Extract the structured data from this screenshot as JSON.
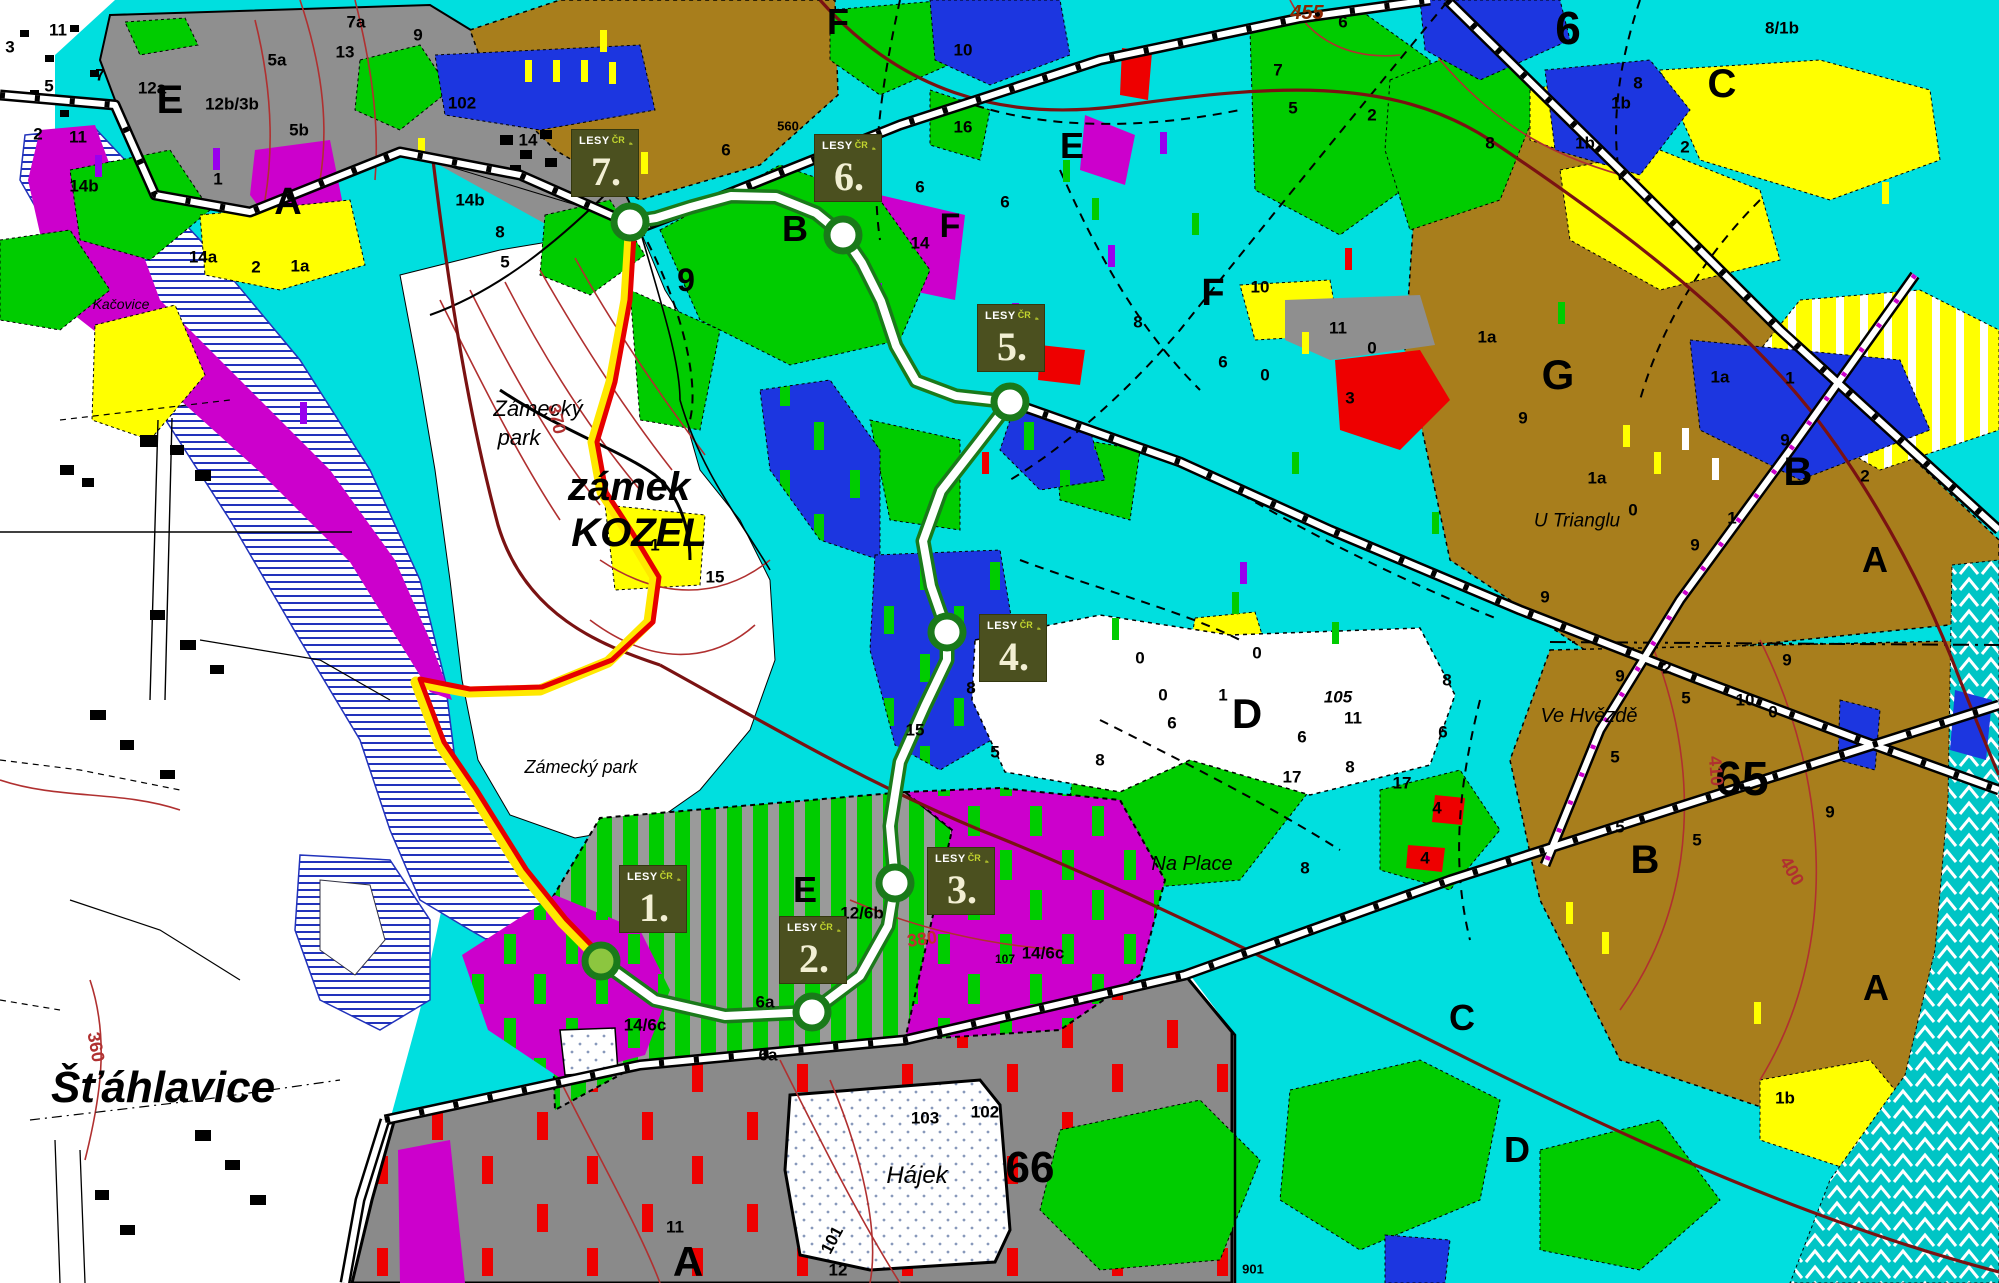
{
  "map": {
    "region_name": "zamek Kozel forest map",
    "marker_logo": {
      "lesy": "LESY",
      "cr": "ČR"
    },
    "waypoints": [
      {
        "id": "1",
        "num": "1.",
        "bx": 620,
        "by": 866,
        "cx": 601,
        "cy": 961,
        "start": true
      },
      {
        "id": "2",
        "num": "2.",
        "bx": 780,
        "by": 917,
        "cx": 812,
        "cy": 1012
      },
      {
        "id": "3",
        "num": "3.",
        "bx": 928,
        "by": 848,
        "cx": 895,
        "cy": 883
      },
      {
        "id": "4",
        "num": "4.",
        "bx": 980,
        "by": 615,
        "cx": 947,
        "cy": 632
      },
      {
        "id": "5",
        "num": "5.",
        "bx": 978,
        "by": 305,
        "cx": 1010,
        "cy": 402
      },
      {
        "id": "6",
        "num": "6.",
        "bx": 815,
        "by": 135,
        "cx": 843,
        "cy": 235
      },
      {
        "id": "7",
        "num": "7.",
        "bx": 572,
        "by": 130,
        "cx": 630,
        "cy": 222
      }
    ]
  },
  "labels": [
    {
      "t": "Šťáhlavice",
      "x": 163,
      "y": 1088,
      "s": 44,
      "i": 1,
      "fw": "b",
      "n": "village-label"
    },
    {
      "t": "zámek",
      "x": 629,
      "y": 487,
      "s": 40,
      "i": 1,
      "fw": "b",
      "n": "castle-label"
    },
    {
      "t": "KOZEL",
      "x": 639,
      "y": 533,
      "s": 40,
      "i": 1,
      "fw": "b",
      "n": "castle-label"
    },
    {
      "t": "Zámecký",
      "x": 538,
      "y": 409,
      "s": 22,
      "i": 1,
      "fw": "n",
      "n": "park-label"
    },
    {
      "t": "park",
      "x": 519,
      "y": 438,
      "s": 22,
      "i": 1,
      "fw": "n",
      "n": "park-label"
    },
    {
      "t": "Zámecký park",
      "x": 581,
      "y": 767,
      "s": 18,
      "i": 1,
      "fw": "n",
      "n": "park-label"
    },
    {
      "t": "Hájek",
      "x": 917,
      "y": 1176,
      "s": 24,
      "i": 1,
      "fw": "n",
      "n": "place-label"
    },
    {
      "t": "Na Place",
      "x": 1192,
      "y": 864,
      "s": 20,
      "i": 1,
      "fw": "n",
      "n": "place-label"
    },
    {
      "t": "Ve Hvězdě",
      "x": 1589,
      "y": 716,
      "s": 20,
      "i": 1,
      "fw": "n",
      "n": "place-label"
    },
    {
      "t": "U Trianglu",
      "x": 1577,
      "y": 521,
      "s": 19,
      "i": 1,
      "fw": "n",
      "n": "place-label"
    },
    {
      "t": "Kačovice",
      "x": 121,
      "y": 304,
      "s": 14,
      "i": 1,
      "fw": "n",
      "n": "place-label"
    },
    {
      "t": "E",
      "x": 170,
      "y": 100,
      "s": 40,
      "n": "section-letter"
    },
    {
      "t": "A",
      "x": 288,
      "y": 202,
      "s": 38,
      "n": "section-letter"
    },
    {
      "t": "F",
      "x": 838,
      "y": 22,
      "s": 36,
      "n": "section-letter"
    },
    {
      "t": "F",
      "x": 950,
      "y": 226,
      "s": 34,
      "n": "section-letter"
    },
    {
      "t": "E",
      "x": 1072,
      "y": 146,
      "s": 36,
      "n": "section-letter"
    },
    {
      "t": "B",
      "x": 795,
      "y": 229,
      "s": 36,
      "n": "section-letter"
    },
    {
      "t": "9",
      "x": 686,
      "y": 280,
      "s": 32,
      "n": "section-number"
    },
    {
      "t": "F",
      "x": 1213,
      "y": 293,
      "s": 38,
      "n": "section-letter"
    },
    {
      "t": "6",
      "x": 1568,
      "y": 28,
      "s": 46,
      "n": "section-number"
    },
    {
      "t": "C",
      "x": 1722,
      "y": 84,
      "s": 40,
      "n": "section-letter"
    },
    {
      "t": "G",
      "x": 1558,
      "y": 375,
      "s": 42,
      "n": "section-letter"
    },
    {
      "t": "B",
      "x": 1798,
      "y": 472,
      "s": 40,
      "n": "section-letter"
    },
    {
      "t": "A",
      "x": 1875,
      "y": 560,
      "s": 36,
      "n": "section-letter"
    },
    {
      "t": "B",
      "x": 1645,
      "y": 860,
      "s": 40,
      "n": "section-letter"
    },
    {
      "t": "65",
      "x": 1742,
      "y": 780,
      "s": 48,
      "fw": "b",
      "n": "section-number"
    },
    {
      "t": "A",
      "x": 1876,
      "y": 988,
      "s": 36,
      "n": "section-letter"
    },
    {
      "t": "D",
      "x": 1247,
      "y": 714,
      "s": 42,
      "n": "section-letter"
    },
    {
      "t": "C",
      "x": 1462,
      "y": 1018,
      "s": 36,
      "n": "section-letter"
    },
    {
      "t": "D",
      "x": 1517,
      "y": 1150,
      "s": 36,
      "n": "section-letter"
    },
    {
      "t": "E",
      "x": 805,
      "y": 890,
      "s": 36,
      "n": "section-letter"
    },
    {
      "t": "A",
      "x": 688,
      "y": 1262,
      "s": 42,
      "n": "section-letter"
    },
    {
      "t": "66",
      "x": 1030,
      "y": 1168,
      "s": 44,
      "fw": "b",
      "n": "section-number"
    },
    {
      "t": "370",
      "x": 557,
      "y": 419,
      "s": 18,
      "r": 78,
      "c": "#B03030",
      "n": "contour-label"
    },
    {
      "t": "360",
      "x": 96,
      "y": 1047,
      "s": 18,
      "r": 80,
      "c": "#B03030",
      "n": "contour-label"
    },
    {
      "t": "380",
      "x": 922,
      "y": 939,
      "s": 18,
      "r": -8,
      "c": "#C03030",
      "n": "contour-label"
    },
    {
      "t": "410",
      "x": 1716,
      "y": 771,
      "s": 18,
      "r": 85,
      "c": "#B03030",
      "n": "contour-label"
    },
    {
      "t": "400",
      "x": 1792,
      "y": 871,
      "s": 18,
      "r": 60,
      "c": "#B03030",
      "n": "contour-label"
    },
    {
      "t": "455",
      "x": 1307,
      "y": 13,
      "s": 20,
      "i": 1,
      "c": "#8B2500",
      "n": "contour-label"
    },
    {
      "t": "560",
      "x": 788,
      "y": 126,
      "s": 13,
      "n": "height-label"
    },
    {
      "t": "901",
      "x": 1253,
      "y": 1269,
      "s": 13,
      "n": "parcel-label"
    },
    {
      "t": "107",
      "x": 1005,
      "y": 959,
      "s": 12,
      "n": "parcel-label"
    },
    {
      "t": "7a",
      "x": 356,
      "y": 22
    },
    {
      "t": "12a",
      "x": 152,
      "y": 88
    },
    {
      "t": "12b/3b",
      "x": 232,
      "y": 104
    },
    {
      "t": "5a",
      "x": 277,
      "y": 60
    },
    {
      "t": "5b",
      "x": 299,
      "y": 130
    },
    {
      "t": "11",
      "x": 78,
      "y": 137
    },
    {
      "t": "14b",
      "x": 84,
      "y": 186
    },
    {
      "t": "14a",
      "x": 203,
      "y": 257
    },
    {
      "t": "1a",
      "x": 300,
      "y": 266
    },
    {
      "t": "2",
      "x": 256,
      "y": 267
    },
    {
      "t": "1",
      "x": 218,
      "y": 179
    },
    {
      "t": "7",
      "x": 100,
      "y": 75
    },
    {
      "t": "2",
      "x": 38,
      "y": 134
    },
    {
      "t": "3",
      "x": 10,
      "y": 47
    },
    {
      "t": "11",
      "x": 58,
      "y": 30
    },
    {
      "t": "5",
      "x": 49,
      "y": 86
    },
    {
      "t": "14b",
      "x": 470,
      "y": 200
    },
    {
      "t": "5",
      "x": 505,
      "y": 262
    },
    {
      "t": "102",
      "x": 462,
      "y": 103
    },
    {
      "t": "9",
      "x": 418,
      "y": 35
    },
    {
      "t": "13",
      "x": 345,
      "y": 52
    },
    {
      "t": "14",
      "x": 528,
      "y": 140
    },
    {
      "t": "8",
      "x": 500,
      "y": 232
    },
    {
      "t": "6",
      "x": 726,
      "y": 150
    },
    {
      "t": "1",
      "x": 655,
      "y": 545
    },
    {
      "t": "15",
      "x": 715,
      "y": 577
    },
    {
      "t": "12/6b",
      "x": 862,
      "y": 913
    },
    {
      "t": "14/6c",
      "x": 645,
      "y": 1025
    },
    {
      "t": "14/6c",
      "x": 1043,
      "y": 953
    },
    {
      "t": "6a",
      "x": 765,
      "y": 1002
    },
    {
      "t": "6a",
      "x": 768,
      "y": 1055
    },
    {
      "t": "103",
      "x": 925,
      "y": 1118
    },
    {
      "t": "102",
      "x": 985,
      "y": 1112
    },
    {
      "t": "101",
      "x": 832,
      "y": 1240,
      "r": -62
    },
    {
      "t": "11",
      "x": 675,
      "y": 1227
    },
    {
      "t": "12",
      "x": 838,
      "y": 1270
    },
    {
      "t": "105",
      "x": 1338,
      "y": 697,
      "i": 1
    },
    {
      "t": "11",
      "x": 1353,
      "y": 718
    },
    {
      "t": "17",
      "x": 1292,
      "y": 777
    },
    {
      "t": "17",
      "x": 1402,
      "y": 783
    },
    {
      "t": "11",
      "x": 1338,
      "y": 328
    },
    {
      "t": "3",
      "x": 1350,
      "y": 398
    },
    {
      "t": "0",
      "x": 1265,
      "y": 375
    },
    {
      "t": "0",
      "x": 1372,
      "y": 348
    },
    {
      "t": "10",
      "x": 1260,
      "y": 287
    },
    {
      "t": "1a",
      "x": 1487,
      "y": 337
    },
    {
      "t": "1a",
      "x": 1720,
      "y": 377
    },
    {
      "t": "1",
      "x": 1790,
      "y": 378
    },
    {
      "t": "9",
      "x": 1785,
      "y": 440
    },
    {
      "t": "9",
      "x": 1523,
      "y": 418
    },
    {
      "t": "2",
      "x": 1865,
      "y": 476
    },
    {
      "t": "1",
      "x": 1732,
      "y": 518
    },
    {
      "t": "0",
      "x": 1633,
      "y": 510
    },
    {
      "t": "9",
      "x": 1695,
      "y": 545
    },
    {
      "t": "1a",
      "x": 1597,
      "y": 478
    },
    {
      "t": "9",
      "x": 1545,
      "y": 597
    },
    {
      "t": "9",
      "x": 1787,
      "y": 660
    },
    {
      "t": "8/1b",
      "x": 1782,
      "y": 28
    },
    {
      "t": "1b",
      "x": 1621,
      "y": 103
    },
    {
      "t": "1b",
      "x": 1585,
      "y": 143
    },
    {
      "t": "8",
      "x": 1638,
      "y": 83
    },
    {
      "t": "2",
      "x": 1685,
      "y": 147
    },
    {
      "t": "7",
      "x": 1278,
      "y": 70
    },
    {
      "t": "5",
      "x": 1293,
      "y": 108
    },
    {
      "t": "6",
      "x": 1343,
      "y": 22
    },
    {
      "t": "2",
      "x": 1372,
      "y": 115
    },
    {
      "t": "8",
      "x": 1490,
      "y": 143
    },
    {
      "t": "16",
      "x": 963,
      "y": 127
    },
    {
      "t": "10",
      "x": 963,
      "y": 50
    },
    {
      "t": "14",
      "x": 920,
      "y": 243
    },
    {
      "t": "6",
      "x": 920,
      "y": 187
    },
    {
      "t": "6",
      "x": 1005,
      "y": 202
    },
    {
      "t": "8",
      "x": 1138,
      "y": 322
    },
    {
      "t": "6",
      "x": 1223,
      "y": 362
    },
    {
      "t": "0",
      "x": 1140,
      "y": 658
    },
    {
      "t": "0",
      "x": 1163,
      "y": 695
    },
    {
      "t": "6",
      "x": 1172,
      "y": 723
    },
    {
      "t": "5",
      "x": 995,
      "y": 752
    },
    {
      "t": "8",
      "x": 1100,
      "y": 760
    },
    {
      "t": "8",
      "x": 971,
      "y": 688
    },
    {
      "t": "15",
      "x": 915,
      "y": 730
    },
    {
      "t": "9",
      "x": 1620,
      "y": 676
    },
    {
      "t": "5",
      "x": 1615,
      "y": 757
    },
    {
      "t": "2",
      "x": 1667,
      "y": 668
    },
    {
      "t": "10",
      "x": 1745,
      "y": 700
    },
    {
      "t": "0",
      "x": 1773,
      "y": 712
    },
    {
      "t": "5",
      "x": 1686,
      "y": 698
    },
    {
      "t": "5",
      "x": 1620,
      "y": 827
    },
    {
      "t": "5",
      "x": 1697,
      "y": 840
    },
    {
      "t": "9",
      "x": 1830,
      "y": 812
    },
    {
      "t": "4",
      "x": 1437,
      "y": 808
    },
    {
      "t": "4",
      "x": 1425,
      "y": 858
    },
    {
      "t": "0",
      "x": 1257,
      "y": 653
    },
    {
      "t": "1",
      "x": 1223,
      "y": 695
    },
    {
      "t": "6",
      "x": 1302,
      "y": 737
    },
    {
      "t": "8",
      "x": 1350,
      "y": 767
    },
    {
      "t": "6",
      "x": 1443,
      "y": 732
    },
    {
      "t": "8",
      "x": 1447,
      "y": 680
    },
    {
      "t": "8",
      "x": 1305,
      "y": 868
    },
    {
      "t": "1b",
      "x": 1785,
      "y": 1098
    }
  ],
  "colors": {
    "cyan": "#00DFDF",
    "green": "#00CC00",
    "trailGreen": "#1A7A1A",
    "yellow": "#FFFF00",
    "magenta": "#CC00CC",
    "blue": "#1C36E0",
    "brown": "#A87E1C",
    "gray": "#8F8F8F",
    "grayDark": "#8A8A8A",
    "red": "#EE0000",
    "roadRed": "#7A1212",
    "contourRed": "#B03030",
    "markerBox": "#4B501F",
    "markerNum": "#F2EFD3",
    "logoGreen": "#C3D62E",
    "yellowTrail": "#FFE800",
    "redTrail": "#E60000",
    "waterBlue": "#2233BB",
    "startFill": "#8CC63F",
    "knitTeal": "#00C5C5"
  }
}
